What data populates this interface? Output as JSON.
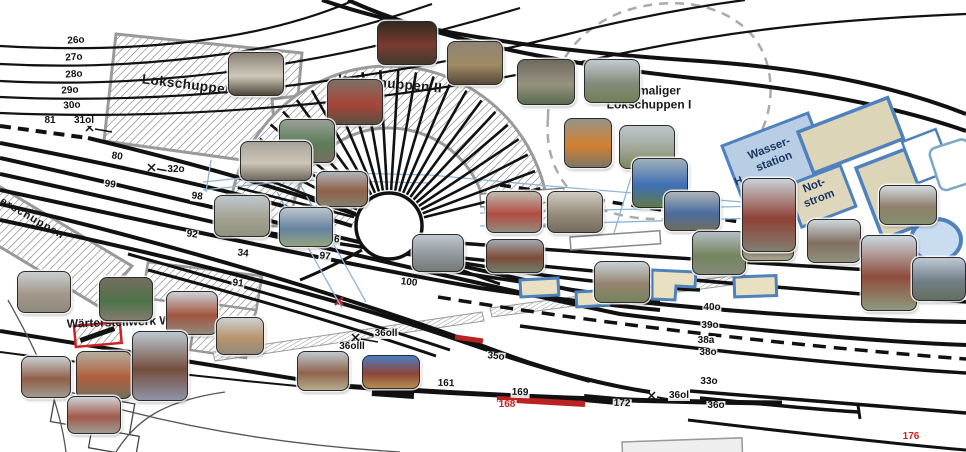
{
  "buildings": {
    "lokschuppen_iii": "Lokschuppen III",
    "lokschuppen_ii": "Lokschuppen II",
    "ehemaliger_line1": "ehemaliger",
    "ehemaliger_line2": "Lokschuppen I",
    "wasserstation_line1": "Wasser-",
    "wasserstation_line2": "station",
    "notstrom_line1": "Not-",
    "notstrom_line2": "strom",
    "gueterschuppen_partial": "erschuppen",
    "waerterstellwerk": "Wärterstellwerk Wm",
    "wasserstation_adjacent_partial": "H"
  },
  "colors": {
    "track": "#111111",
    "building_stroke": "#999999",
    "blue_fill": "#b9cde5",
    "blue_stroke": "#4f81bd",
    "tan_fill": "#ded7bd",
    "red": "#cc2222",
    "water_line": "#8fb4d9"
  },
  "track_labels": [
    {
      "t": "26o",
      "x": 76,
      "y": 41,
      "r": -4
    },
    {
      "t": "27o",
      "x": 74,
      "y": 58,
      "r": -4
    },
    {
      "t": "28o",
      "x": 74,
      "y": 75,
      "r": -4
    },
    {
      "t": "29o",
      "x": 70,
      "y": 91,
      "r": -4
    },
    {
      "t": "30o",
      "x": 72,
      "y": 106,
      "r": -4
    },
    {
      "t": "81",
      "x": 50,
      "y": 121,
      "r": 0
    },
    {
      "t": "31ol",
      "x": 84,
      "y": 121,
      "r": 0
    },
    {
      "t": "80",
      "x": 117,
      "y": 157,
      "r": 8
    },
    {
      "t": "32o",
      "x": 176,
      "y": 170,
      "r": 0
    },
    {
      "t": "99",
      "x": 110,
      "y": 185,
      "r": 8
    },
    {
      "t": "98",
      "x": 197,
      "y": 197,
      "r": 8
    },
    {
      "t": "92",
      "x": 192,
      "y": 235,
      "r": 8
    },
    {
      "t": "34",
      "x": 243,
      "y": 254,
      "r": 6
    },
    {
      "t": "91",
      "x": 238,
      "y": 284,
      "r": 6
    },
    {
      "t": "86",
      "x": 334,
      "y": 240,
      "r": 6
    },
    {
      "t": "97",
      "x": 325,
      "y": 257,
      "r": 6
    },
    {
      "t": "100",
      "x": 409,
      "y": 283,
      "r": 6
    },
    {
      "t": "35o",
      "x": 496,
      "y": 357,
      "r": 6
    },
    {
      "t": "36oll",
      "x": 386,
      "y": 334,
      "r": 0
    },
    {
      "t": "36olll",
      "x": 352,
      "y": 347,
      "r": 0
    },
    {
      "t": "161",
      "x": 446,
      "y": 384,
      "r": 2
    },
    {
      "t": "169",
      "x": 520,
      "y": 393,
      "r": 2
    },
    {
      "t": "168",
      "x": 507,
      "y": 405,
      "r": 0,
      "c": "#cc2222"
    },
    {
      "t": "172",
      "x": 622,
      "y": 404,
      "r": 2
    },
    {
      "t": "36ol",
      "x": 679,
      "y": 396,
      "r": 0
    },
    {
      "t": "33o",
      "x": 709,
      "y": 382,
      "r": 0
    },
    {
      "t": "36o",
      "x": 716,
      "y": 406,
      "r": 0
    },
    {
      "t": "40o",
      "x": 712,
      "y": 308,
      "r": 0
    },
    {
      "t": "39o",
      "x": 710,
      "y": 326,
      "r": 0
    },
    {
      "t": "38a",
      "x": 706,
      "y": 341,
      "r": 0
    },
    {
      "t": "38o",
      "x": 708,
      "y": 353,
      "r": 0
    },
    {
      "t": "176",
      "x": 911,
      "y": 437,
      "r": 0,
      "c": "#cc2222"
    }
  ],
  "photos": [
    {
      "name": "lokschuppen3-hall-interior",
      "x": 228,
      "y": 52,
      "w": 54,
      "h": 42,
      "colors": [
        "#8a8176",
        "#cfc9ba",
        "#4e463a"
      ]
    },
    {
      "name": "dark-engine-shed",
      "x": 377,
      "y": 21,
      "w": 58,
      "h": 42,
      "colors": [
        "#33291f",
        "#7a3a30",
        "#413a30"
      ]
    },
    {
      "name": "red-cabinet-room",
      "x": 327,
      "y": 79,
      "w": 54,
      "h": 44,
      "colors": [
        "#7d7166",
        "#a8453a",
        "#5c4f41"
      ]
    },
    {
      "name": "machine-shop",
      "x": 279,
      "y": 119,
      "w": 54,
      "h": 42,
      "colors": [
        "#9aa098",
        "#5e7d58",
        "#75705f"
      ]
    },
    {
      "name": "vehicle-garage",
      "x": 240,
      "y": 141,
      "w": 70,
      "h": 38,
      "colors": [
        "#a7a49b",
        "#cdc5b6",
        "#6f6a5f"
      ]
    },
    {
      "name": "workshop-table",
      "x": 447,
      "y": 41,
      "w": 54,
      "h": 42,
      "colors": [
        "#8d8578",
        "#a08a64",
        "#55493a"
      ]
    },
    {
      "name": "shed-aisle",
      "x": 517,
      "y": 59,
      "w": 56,
      "h": 44,
      "colors": [
        "#6e6a5f",
        "#97927f",
        "#5a6b4e"
      ]
    },
    {
      "name": "steel-frame-ruin",
      "x": 584,
      "y": 59,
      "w": 54,
      "h": 42,
      "colors": [
        "#c2cad0",
        "#868b7c",
        "#6f8256"
      ]
    },
    {
      "name": "orange-crane",
      "x": 564,
      "y": 118,
      "w": 46,
      "h": 48,
      "colors": [
        "#96948a",
        "#d3802e",
        "#7d7668"
      ]
    },
    {
      "name": "yard-monument",
      "x": 619,
      "y": 125,
      "w": 54,
      "h": 42,
      "colors": [
        "#bdc6cc",
        "#a1a795",
        "#79855f"
      ]
    },
    {
      "name": "blue-pump",
      "x": 632,
      "y": 158,
      "w": 54,
      "h": 48,
      "colors": [
        "#9fb0b8",
        "#3f6fb5",
        "#5e7a4a"
      ]
    },
    {
      "name": "blue-loader-wagon",
      "x": 664,
      "y": 191,
      "w": 54,
      "h": 38,
      "colors": [
        "#aeb4b9",
        "#4a6da0",
        "#6e6d60"
      ]
    },
    {
      "name": "red-lockers",
      "x": 486,
      "y": 191,
      "w": 54,
      "h": 40,
      "colors": [
        "#c0bbb0",
        "#b14c42",
        "#938b7e"
      ]
    },
    {
      "name": "meeting-room",
      "x": 547,
      "y": 191,
      "w": 54,
      "h": 40,
      "colors": [
        "#d0ccc2",
        "#968c7c",
        "#746c5e"
      ]
    },
    {
      "name": "brick-rowhouse",
      "x": 486,
      "y": 239,
      "w": 56,
      "h": 32,
      "colors": [
        "#a3abb2",
        "#7e4c3a",
        "#737d6b"
      ]
    },
    {
      "name": "field-ruins",
      "x": 594,
      "y": 261,
      "w": 54,
      "h": 40,
      "colors": [
        "#c8d2d8",
        "#94846f",
        "#74845e"
      ]
    },
    {
      "name": "green-track-aisle",
      "x": 692,
      "y": 231,
      "w": 52,
      "h": 42,
      "colors": [
        "#b4bec5",
        "#75855f",
        "#83887a"
      ]
    },
    {
      "name": "gravel-siding",
      "x": 742,
      "y": 227,
      "w": 50,
      "h": 32,
      "colors": [
        "#bfc9cf",
        "#8f877a",
        "#a8a088"
      ]
    },
    {
      "name": "heizhaus-tower",
      "x": 742,
      "y": 178,
      "w": 52,
      "h": 72,
      "colors": [
        "#c9d1d7",
        "#8f4136",
        "#837e70"
      ]
    },
    {
      "name": "street-view",
      "x": 807,
      "y": 219,
      "w": 52,
      "h": 42,
      "colors": [
        "#ced7dd",
        "#816f60",
        "#90907f"
      ]
    },
    {
      "name": "house-with-trees",
      "x": 879,
      "y": 185,
      "w": 56,
      "h": 38,
      "colors": [
        "#d2dbe1",
        "#8f7e6c",
        "#84906f"
      ]
    },
    {
      "name": "water-tower",
      "x": 861,
      "y": 235,
      "w": 54,
      "h": 74,
      "colors": [
        "#cbd8e0",
        "#8f4c3c",
        "#8f997f"
      ]
    },
    {
      "name": "signal-gantry",
      "x": 912,
      "y": 257,
      "w": 52,
      "h": 42,
      "colors": [
        "#bcc8d2",
        "#727e88",
        "#646f60"
      ]
    },
    {
      "name": "country-lane",
      "x": 214,
      "y": 195,
      "w": 54,
      "h": 40,
      "colors": [
        "#bfc8ce",
        "#a3a392",
        "#93917f"
      ]
    },
    {
      "name": "brick-building",
      "x": 316,
      "y": 171,
      "w": 50,
      "h": 34,
      "colors": [
        "#aeb6bc",
        "#90604a",
        "#867f6e"
      ]
    },
    {
      "name": "blue-shelter",
      "x": 279,
      "y": 207,
      "w": 52,
      "h": 38,
      "colors": [
        "#bcc5cb",
        "#6782a0",
        "#93a37f"
      ]
    },
    {
      "name": "parking-lot",
      "x": 412,
      "y": 234,
      "w": 50,
      "h": 36,
      "colors": [
        "#bfc8ce",
        "#91979c",
        "#75797a"
      ]
    },
    {
      "name": "station-platform",
      "x": 17,
      "y": 271,
      "w": 52,
      "h": 40,
      "colors": [
        "#cbcfd2",
        "#a3978a",
        "#8f8a7d"
      ]
    },
    {
      "name": "green-loco-exhibit",
      "x": 99,
      "y": 277,
      "w": 52,
      "h": 42,
      "colors": [
        "#756d60",
        "#4e7449",
        "#837b6c"
      ]
    },
    {
      "name": "red-brick-house",
      "x": 166,
      "y": 291,
      "w": 50,
      "h": 42,
      "colors": [
        "#ced3d7",
        "#a3543f",
        "#908a7c"
      ]
    },
    {
      "name": "long-tan-building",
      "x": 216,
      "y": 317,
      "w": 46,
      "h": 36,
      "colors": [
        "#cbcfd2",
        "#b8946c",
        "#908a7c"
      ]
    },
    {
      "name": "small-signalbox",
      "x": 21,
      "y": 356,
      "w": 48,
      "h": 40,
      "colors": [
        "#cbcfd2",
        "#8f5f47",
        "#a09b8f"
      ]
    },
    {
      "name": "lever-frame",
      "x": 76,
      "y": 351,
      "w": 54,
      "h": 46,
      "colors": [
        "#b5ad9d",
        "#b05e3c",
        "#746f5e"
      ]
    },
    {
      "name": "tall-signalbox",
      "x": 132,
      "y": 331,
      "w": 54,
      "h": 68,
      "colors": [
        "#bcc8d2",
        "#744e3e",
        "#9193a8"
      ]
    },
    {
      "name": "red-roof-house",
      "x": 67,
      "y": 396,
      "w": 52,
      "h": 36,
      "colors": [
        "#ced3d7",
        "#a05a4c",
        "#a09d92"
      ]
    },
    {
      "name": "freight-siding",
      "x": 297,
      "y": 351,
      "w": 50,
      "h": 38,
      "colors": [
        "#bfc8ce",
        "#8f634c",
        "#b5ac8d"
      ]
    },
    {
      "name": "red-train-panorama",
      "x": 362,
      "y": 355,
      "w": 56,
      "h": 32,
      "colors": [
        "#4a7ec4",
        "#8f4538",
        "#b58e50"
      ]
    }
  ]
}
